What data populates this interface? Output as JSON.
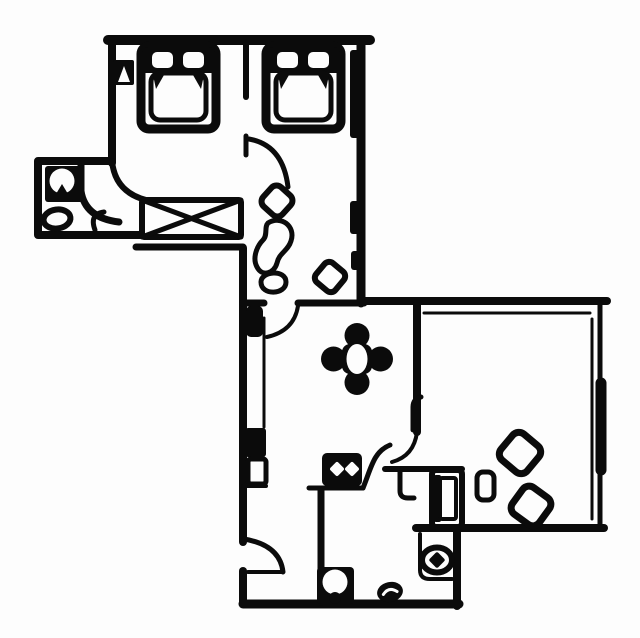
{
  "document": {
    "kind": "floor-plan-line-drawing",
    "description": "Black and white hand-drawn apartment floor plan: two bedrooms with single beds at top, bathroom at left, hallway with crossed wardrobe, corridor leading to a dining area with a four-lobe table, a large living room at right with tilted-square chairs, and a kitchen at bottom with stove, sink and fixtures. Several door swing arcs."
  },
  "colors": {
    "ink": "#0b0b0b",
    "paper": "#fdfdfd"
  },
  "canvas": {
    "width": 640,
    "height": 638
  },
  "rooms": [
    {
      "id": "bedroom-left"
    },
    {
      "id": "bedroom-right"
    },
    {
      "id": "bathroom"
    },
    {
      "id": "hall"
    },
    {
      "id": "corridor"
    },
    {
      "id": "dining-area"
    },
    {
      "id": "living-room"
    },
    {
      "id": "kitchen"
    }
  ],
  "symbols": [
    {
      "id": "single-bed-1",
      "icon": "bed-icon"
    },
    {
      "id": "single-bed-2",
      "icon": "bed-icon"
    },
    {
      "id": "wardrobe",
      "icon": "crossed-rectangle-icon"
    },
    {
      "id": "washbasin",
      "icon": "round-basin-icon"
    },
    {
      "id": "toilet",
      "icon": "oval-toilet-icon"
    },
    {
      "id": "corridor-chair",
      "icon": "tilted-square-icon"
    },
    {
      "id": "corridor-blob-large",
      "icon": "organic-blob-icon"
    },
    {
      "id": "corridor-blob-small",
      "icon": "organic-blob-icon"
    },
    {
      "id": "corridor-stool",
      "icon": "tilted-square-icon"
    },
    {
      "id": "dining-table",
      "icon": "four-lobe-table-icon"
    },
    {
      "id": "stove",
      "icon": "two-burner-stove-icon"
    },
    {
      "id": "kitchen-sink",
      "icon": "round-sink-icon"
    },
    {
      "id": "floor-drain",
      "icon": "small-blob-icon"
    },
    {
      "id": "niche-fixture",
      "icon": "oval-fixture-icon"
    },
    {
      "id": "cabinet",
      "icon": "tall-cabinet-icon"
    },
    {
      "id": "side-table",
      "icon": "small-rounded-rectangle-icon"
    },
    {
      "id": "living-chair-1",
      "icon": "tilted-square-icon"
    },
    {
      "id": "living-chair-2",
      "icon": "tilted-square-icon"
    },
    {
      "id": "window-mark",
      "icon": "triangle-notch-icon"
    },
    {
      "id": "radiator-a",
      "icon": "solid-bar-icon"
    },
    {
      "id": "radiator-b",
      "icon": "solid-bar-icon"
    }
  ],
  "door_swings": 7
}
